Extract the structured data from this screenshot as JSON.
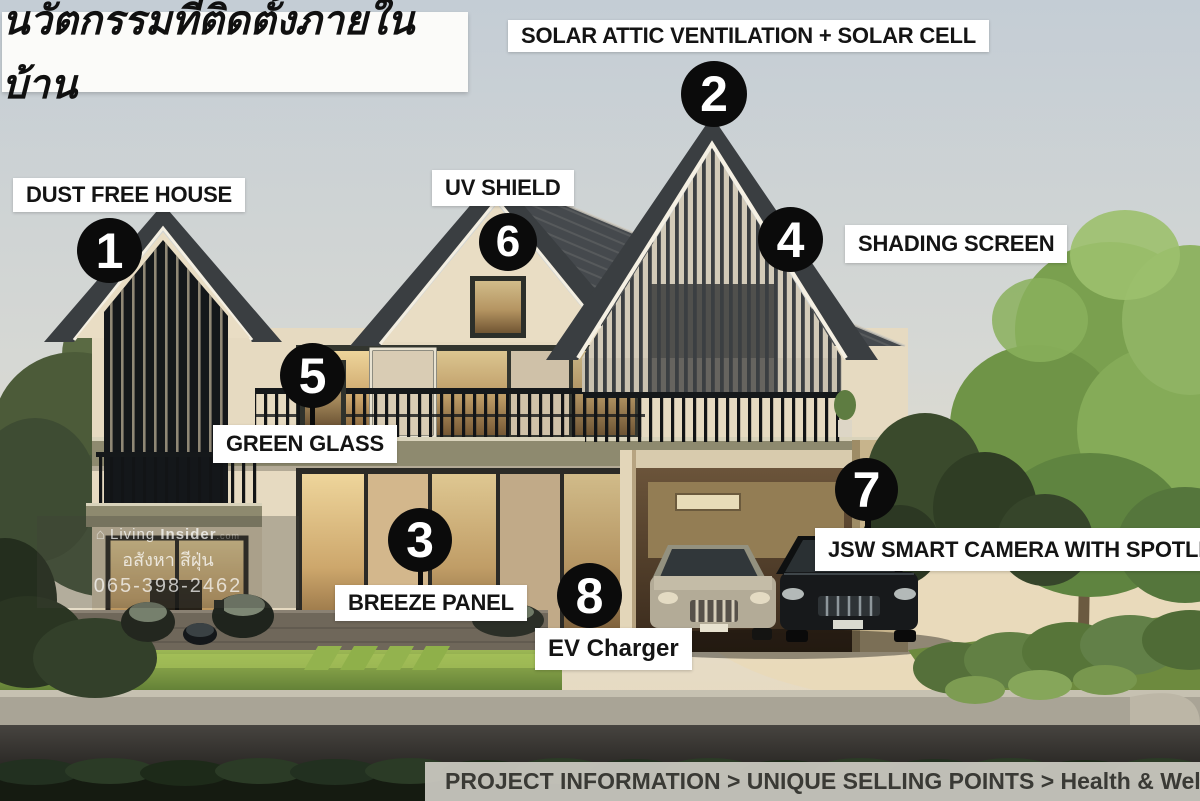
{
  "slide": {
    "title": "นวัตกรรมที่ติดตั้งภายในบ้าน"
  },
  "annotations": [
    {
      "number": "1",
      "label": "DUST FREE HOUSE"
    },
    {
      "number": "2",
      "label": "SOLAR ATTIC VENTILATION + SOLAR CELL"
    },
    {
      "number": "3",
      "label": "BREEZE PANEL"
    },
    {
      "number": "4",
      "label": "SHADING SCREEN"
    },
    {
      "number": "5",
      "label": "GREEN GLASS"
    },
    {
      "number": "6",
      "label": "UV SHIELD"
    },
    {
      "number": "7",
      "label": "JSW  SMART CAMERA WITH SPOTLIGHT"
    },
    {
      "number": "8",
      "label": "EV Charger"
    }
  ],
  "watermark": {
    "brand_light": "Living",
    "brand_bold": "Insider",
    "brand_suffix": ".com",
    "line2": "อสังหา สีฝุ่น",
    "line3": "065-398-2462"
  },
  "footer": {
    "breadcrumb": "PROJECT INFORMATION > UNIQUE SELLING POINTS > Health & Well-Bein"
  },
  "colors": {
    "marker_bg": "#0b0b0b",
    "marker_text": "#ffffff",
    "label_bg": "#ffffff",
    "label_text": "#141414",
    "footer_bg": "#cbc9c2",
    "footer_text": "#3a3a35",
    "sky_top": "#c4cdd5",
    "roof": "#3a3e41",
    "wall": "#e7dcc3",
    "lawn": "#7a9a42"
  }
}
